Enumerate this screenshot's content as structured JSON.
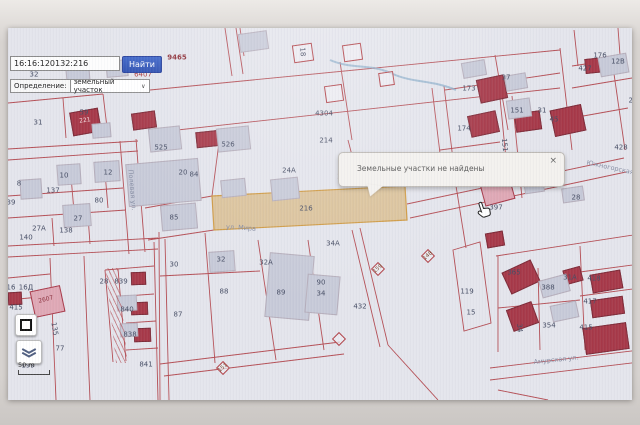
{
  "search": {
    "query": "16:16:120132:216",
    "button_label": "Найти"
  },
  "filter": {
    "label": "Определение:",
    "value": "земельный участок"
  },
  "tooltip": {
    "text": "Земельные участки не найдены",
    "close_label": "×"
  },
  "map_controls": {
    "scale_label": "50 m"
  },
  "icons": {
    "chevron_down": "∨"
  },
  "colors": {
    "accent_blue": "#3e66c9",
    "parcel_line": "#b04046",
    "building_red": "#a63848",
    "building_pink": "#dfa8b5",
    "building_gray": "#c7cad8",
    "highlight_fill": "#d9bd8e",
    "highlight_border": "#cf9a43",
    "label_dark": "#454c63",
    "label_red": "#a8353a",
    "street_blue": "#868da3",
    "map_bg": "#e4e5ec",
    "tooltip_bg": "#f3f1ee",
    "stream_blue": "#85aac8"
  },
  "map": {
    "labels": [
      {
        "t": "9465",
        "x": 169,
        "y": 30,
        "c": "red2"
      },
      {
        "t": "32",
        "x": 26,
        "y": 47
      },
      {
        "t": "6407",
        "x": 135,
        "y": 47,
        "c": "red"
      },
      {
        "t": "31",
        "x": 30,
        "y": 95
      },
      {
        "t": "59",
        "x": 76,
        "y": 85
      },
      {
        "t": "221",
        "x": 77,
        "y": 93,
        "r": -8,
        "c": "onred"
      },
      {
        "t": "8",
        "x": 11,
        "y": 156
      },
      {
        "t": "10",
        "x": 56,
        "y": 148
      },
      {
        "t": "12",
        "x": 100,
        "y": 145
      },
      {
        "t": "137",
        "x": 45,
        "y": 163
      },
      {
        "t": "80",
        "x": 91,
        "y": 173
      },
      {
        "t": "39",
        "x": 3,
        "y": 175
      },
      {
        "t": "27",
        "x": 70,
        "y": 191
      },
      {
        "t": "27А",
        "x": 31,
        "y": 201
      },
      {
        "t": "140",
        "x": 18,
        "y": 210
      },
      {
        "t": "138",
        "x": 58,
        "y": 203
      },
      {
        "t": "525",
        "x": 153,
        "y": 120
      },
      {
        "t": "526",
        "x": 220,
        "y": 117
      },
      {
        "t": "20",
        "x": 175,
        "y": 145
      },
      {
        "t": "84",
        "x": 186,
        "y": 147
      },
      {
        "t": "85",
        "x": 166,
        "y": 190
      },
      {
        "t": "24А",
        "x": 281,
        "y": 143
      },
      {
        "t": "219",
        "x": 336,
        "y": 149,
        "c": "red"
      },
      {
        "t": "4304",
        "x": 316,
        "y": 86
      },
      {
        "t": "214",
        "x": 318,
        "y": 113
      },
      {
        "t": "216",
        "x": 298,
        "y": 181
      },
      {
        "t": "18",
        "x": 294,
        "y": 24,
        "r": 85
      },
      {
        "t": "34А",
        "x": 325,
        "y": 216
      },
      {
        "t": "30",
        "x": 166,
        "y": 237
      },
      {
        "t": "32",
        "x": 213,
        "y": 232
      },
      {
        "t": "32А",
        "x": 258,
        "y": 235
      },
      {
        "t": "88",
        "x": 216,
        "y": 264
      },
      {
        "t": "87",
        "x": 170,
        "y": 287
      },
      {
        "t": "89",
        "x": 273,
        "y": 265
      },
      {
        "t": "90",
        "x": 313,
        "y": 255
      },
      {
        "t": "34",
        "x": 313,
        "y": 266
      },
      {
        "t": "432",
        "x": 352,
        "y": 279
      },
      {
        "t": "119",
        "x": 459,
        "y": 264
      },
      {
        "t": "15",
        "x": 463,
        "y": 285
      },
      {
        "t": "151",
        "x": 496,
        "y": 117,
        "r": 85
      },
      {
        "t": "173",
        "x": 461,
        "y": 61
      },
      {
        "t": "174",
        "x": 456,
        "y": 101
      },
      {
        "t": "37",
        "x": 498,
        "y": 50
      },
      {
        "t": "151",
        "x": 509,
        "y": 83
      },
      {
        "t": "31",
        "x": 534,
        "y": 83
      },
      {
        "t": "45",
        "x": 546,
        "y": 92
      },
      {
        "t": "427",
        "x": 577,
        "y": 41
      },
      {
        "t": "176",
        "x": 592,
        "y": 28
      },
      {
        "t": "12В",
        "x": 610,
        "y": 34
      },
      {
        "t": "27",
        "x": 625,
        "y": 73
      },
      {
        "t": "428",
        "x": 613,
        "y": 120
      },
      {
        "t": "30",
        "x": 530,
        "y": 155
      },
      {
        "t": "28",
        "x": 568,
        "y": 170
      },
      {
        "t": "397",
        "x": 488,
        "y": 180
      },
      {
        "t": "365",
        "x": 506,
        "y": 245
      },
      {
        "t": "388",
        "x": 540,
        "y": 260
      },
      {
        "t": "31А",
        "x": 562,
        "y": 250
      },
      {
        "t": "418",
        "x": 586,
        "y": 251
      },
      {
        "t": "417",
        "x": 582,
        "y": 274
      },
      {
        "t": "415",
        "x": 578,
        "y": 300
      },
      {
        "t": "354",
        "x": 541,
        "y": 298
      },
      {
        "t": "34",
        "x": 511,
        "y": 300,
        "r": 85
      },
      {
        "t": "16",
        "x": 3,
        "y": 260
      },
      {
        "t": "16Д",
        "x": 18,
        "y": 260
      },
      {
        "t": "415",
        "x": 8,
        "y": 280
      },
      {
        "t": "2607",
        "x": 38,
        "y": 272,
        "r": -14,
        "c": "onpink"
      },
      {
        "t": "28",
        "x": 96,
        "y": 254
      },
      {
        "t": "839",
        "x": 113,
        "y": 254
      },
      {
        "t": "840",
        "x": 119,
        "y": 282
      },
      {
        "t": "838",
        "x": 122,
        "y": 307
      },
      {
        "t": "841",
        "x": 138,
        "y": 337
      },
      {
        "t": "135",
        "x": 46,
        "y": 301,
        "r": 80
      },
      {
        "t": "77",
        "x": 52,
        "y": 321
      },
      {
        "t": "199",
        "x": 20,
        "y": 338
      },
      {
        "t": "Полевая ул.",
        "x": 124,
        "y": 162,
        "r": 85,
        "c": "street"
      },
      {
        "t": "ул. Мира",
        "x": 233,
        "y": 200,
        "r": 4,
        "c": "street"
      },
      {
        "t": "Амурская ул.",
        "x": 548,
        "y": 332,
        "r": -6,
        "c": "street"
      },
      {
        "t": "Южногорская ул.",
        "x": 608,
        "y": 141,
        "r": 12,
        "c": "street"
      }
    ],
    "diamonds": [
      {
        "t": "159",
        "x": 370,
        "y": 241
      },
      {
        "t": "148",
        "x": 420,
        "y": 228
      },
      {
        "t": "151",
        "x": 215,
        "y": 340
      },
      {
        "t": "",
        "x": 331,
        "y": 311
      }
    ],
    "buildings": [
      {
        "x": 63,
        "y": 82,
        "w": 27,
        "h": 22,
        "r": -10,
        "type": "red"
      },
      {
        "x": 124,
        "y": 84,
        "w": 22,
        "h": 15,
        "r": -8,
        "type": "red"
      },
      {
        "x": 188,
        "y": 103,
        "w": 23,
        "h": 14,
        "r": -6,
        "type": "red"
      },
      {
        "x": 470,
        "y": 49,
        "w": 26,
        "h": 22,
        "r": -12,
        "type": "red"
      },
      {
        "x": 461,
        "y": 85,
        "w": 27,
        "h": 20,
        "r": -12,
        "type": "red"
      },
      {
        "x": 507,
        "y": 84,
        "w": 24,
        "h": 17,
        "r": -8,
        "type": "red"
      },
      {
        "x": 544,
        "y": 79,
        "w": 30,
        "h": 25,
        "r": -12,
        "type": "red"
      },
      {
        "x": 577,
        "y": 30,
        "w": 19,
        "h": 13,
        "r": -6,
        "type": "red"
      },
      {
        "x": 478,
        "y": 204,
        "w": 16,
        "h": 13,
        "r": -10,
        "type": "red"
      },
      {
        "x": 497,
        "y": 237,
        "w": 30,
        "h": 22,
        "r": -25,
        "type": "red"
      },
      {
        "x": 501,
        "y": 277,
        "w": 25,
        "h": 21,
        "r": -20,
        "type": "red"
      },
      {
        "x": 556,
        "y": 240,
        "w": 16,
        "h": 13,
        "r": -15,
        "type": "red"
      },
      {
        "x": 583,
        "y": 244,
        "w": 29,
        "h": 17,
        "r": -10,
        "type": "red"
      },
      {
        "x": 583,
        "y": 270,
        "w": 31,
        "h": 16,
        "r": -8,
        "type": "red"
      },
      {
        "x": 576,
        "y": 297,
        "w": 42,
        "h": 25,
        "r": -8,
        "type": "red"
      },
      {
        "x": 0,
        "y": 264,
        "w": 12,
        "h": 11,
        "r": -3,
        "type": "red"
      },
      {
        "x": 123,
        "y": 244,
        "w": 13,
        "h": 11,
        "r": -2,
        "type": "red"
      },
      {
        "x": 123,
        "y": 274,
        "w": 15,
        "h": 11,
        "r": -2,
        "type": "red"
      },
      {
        "x": 126,
        "y": 300,
        "w": 15,
        "h": 12,
        "r": -2,
        "type": "red"
      },
      {
        "x": 24,
        "y": 260,
        "w": 29,
        "h": 25,
        "r": -12,
        "type": "pink"
      },
      {
        "x": 474,
        "y": 152,
        "w": 29,
        "h": 21,
        "r": -15,
        "type": "pink"
      },
      {
        "x": 285,
        "y": 16,
        "w": 18,
        "h": 16,
        "r": -8,
        "type": "outline"
      },
      {
        "x": 335,
        "y": 16,
        "w": 17,
        "h": 15,
        "r": -8,
        "type": "outline"
      },
      {
        "x": 371,
        "y": 44,
        "w": 13,
        "h": 12,
        "r": -8,
        "type": "outline"
      },
      {
        "x": 317,
        "y": 57,
        "w": 16,
        "h": 15,
        "r": -8,
        "type": "outline"
      },
      {
        "x": 84,
        "y": 95,
        "w": 17,
        "h": 13,
        "r": -5,
        "type": "gray"
      },
      {
        "x": 12,
        "y": 151,
        "w": 20,
        "h": 18,
        "r": -4,
        "type": "gray"
      },
      {
        "x": 49,
        "y": 136,
        "w": 22,
        "h": 19,
        "r": -4,
        "type": "gray"
      },
      {
        "x": 86,
        "y": 133,
        "w": 24,
        "h": 19,
        "r": -4,
        "type": "gray"
      },
      {
        "x": 55,
        "y": 176,
        "w": 26,
        "h": 21,
        "r": -4,
        "type": "gray"
      },
      {
        "x": 141,
        "y": 99,
        "w": 30,
        "h": 22,
        "r": -6,
        "type": "gray"
      },
      {
        "x": 209,
        "y": 99,
        "w": 31,
        "h": 22,
        "r": -6,
        "type": "gray"
      },
      {
        "x": 119,
        "y": 133,
        "w": 71,
        "h": 41,
        "r": -5,
        "type": "gray"
      },
      {
        "x": 153,
        "y": 176,
        "w": 34,
        "h": 24,
        "r": -5,
        "type": "gray"
      },
      {
        "x": 213,
        "y": 151,
        "w": 23,
        "h": 16,
        "r": -6,
        "type": "gray"
      },
      {
        "x": 263,
        "y": 150,
        "w": 26,
        "h": 20,
        "r": -6,
        "type": "gray"
      },
      {
        "x": 231,
        "y": 4,
        "w": 27,
        "h": 17,
        "r": -8,
        "type": "gray"
      },
      {
        "x": 259,
        "y": 226,
        "w": 43,
        "h": 63,
        "r": 5,
        "type": "gray"
      },
      {
        "x": 298,
        "y": 247,
        "w": 31,
        "h": 37,
        "r": 5,
        "type": "gray"
      },
      {
        "x": 201,
        "y": 223,
        "w": 24,
        "h": 19,
        "r": -4,
        "type": "gray"
      },
      {
        "x": 499,
        "y": 71,
        "w": 22,
        "h": 17,
        "r": -8,
        "type": "gray"
      },
      {
        "x": 591,
        "y": 27,
        "w": 27,
        "h": 18,
        "r": -10,
        "type": "gray"
      },
      {
        "x": 516,
        "y": 150,
        "w": 18,
        "h": 13,
        "r": -8,
        "type": "gray"
      },
      {
        "x": 554,
        "y": 159,
        "w": 20,
        "h": 13,
        "r": -8,
        "type": "gray"
      },
      {
        "x": 109,
        "y": 267,
        "w": 18,
        "h": 14,
        "r": -3,
        "type": "gray"
      },
      {
        "x": 112,
        "y": 295,
        "w": 16,
        "h": 12,
        "r": -3,
        "type": "gray"
      },
      {
        "x": 532,
        "y": 249,
        "w": 27,
        "h": 16,
        "r": -15,
        "type": "gray"
      },
      {
        "x": 543,
        "y": 275,
        "w": 25,
        "h": 15,
        "r": -12,
        "type": "gray"
      },
      {
        "x": 58,
        "y": 38,
        "w": 22,
        "h": 16,
        "r": -5,
        "type": "gray"
      },
      {
        "x": 98,
        "y": 32,
        "w": 20,
        "h": 15,
        "r": -5,
        "type": "gray"
      },
      {
        "x": 454,
        "y": 33,
        "w": 22,
        "h": 14,
        "r": -10,
        "type": "gray"
      },
      {
        "x": 497,
        "y": 46,
        "w": 20,
        "h": 14,
        "r": -10,
        "type": "gray"
      }
    ]
  }
}
